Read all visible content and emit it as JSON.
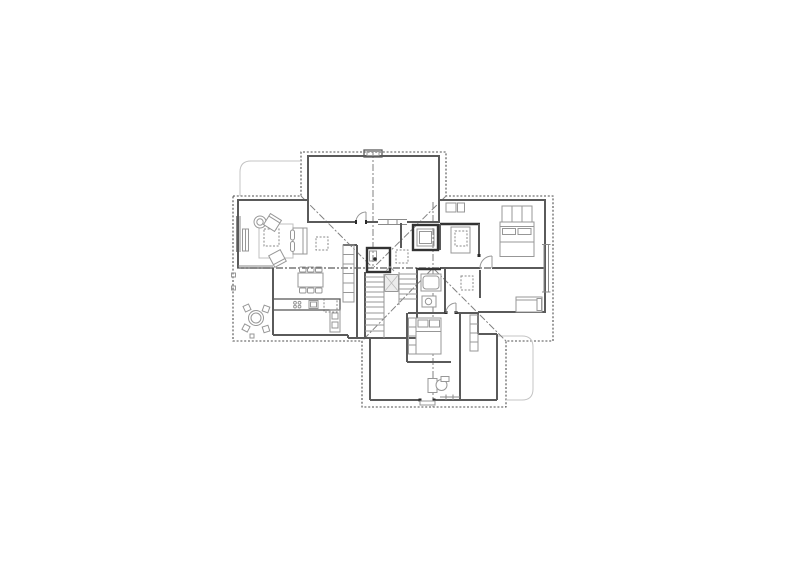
{
  "canvas": {
    "width": 800,
    "height": 565,
    "background": "#ffffff"
  },
  "figure": {
    "kind": "architectural floor plan line drawing",
    "text_labels": "none visible",
    "depicted": {
      "roof_overhang_outline": "dotted cross-shaped boundary",
      "roof_lines": [
        "main horizontal ridge",
        "top wing ridge",
        "bottom wing ridge",
        "four 45-degree valley lines"
      ],
      "rooms": [
        "double-height top room",
        "living room",
        "dining area",
        "kitchen",
        "covered terrace",
        "stair core",
        "shower room",
        "wc",
        "bathroom",
        "corridors",
        "bedroom right-top",
        "bedroom right-bottom",
        "bedroom bottom wing",
        "desk room"
      ],
      "furniture": [
        "sofa",
        "two armchairs",
        "rug",
        "coffee table (dashed)",
        "round side table",
        "sideboard",
        "dining table with six chairs",
        "kitchen counter with sink and cooktop",
        "round terrace table with four chairs",
        "double bed with pillows",
        "wardrobe",
        "single bed/bench",
        "bed with shelf",
        "shelving units",
        "desk with chair",
        "staircase with landing"
      ],
      "skylights_dashed_squares": 5
    }
  },
  "palette": {
    "background": "#ffffff",
    "roof_outline": "#4f4f4f",
    "wall": "#5a5a5a",
    "wall_heavy": "#333333",
    "furniture": "#979797",
    "faint_path": "#c4c4c4",
    "glazing": "#8a8a8a",
    "axis_line": "#828282",
    "ridge_line": "#5c5c5c",
    "landing_fill": "#ececec",
    "door_jamb": "#2a2a2a"
  }
}
